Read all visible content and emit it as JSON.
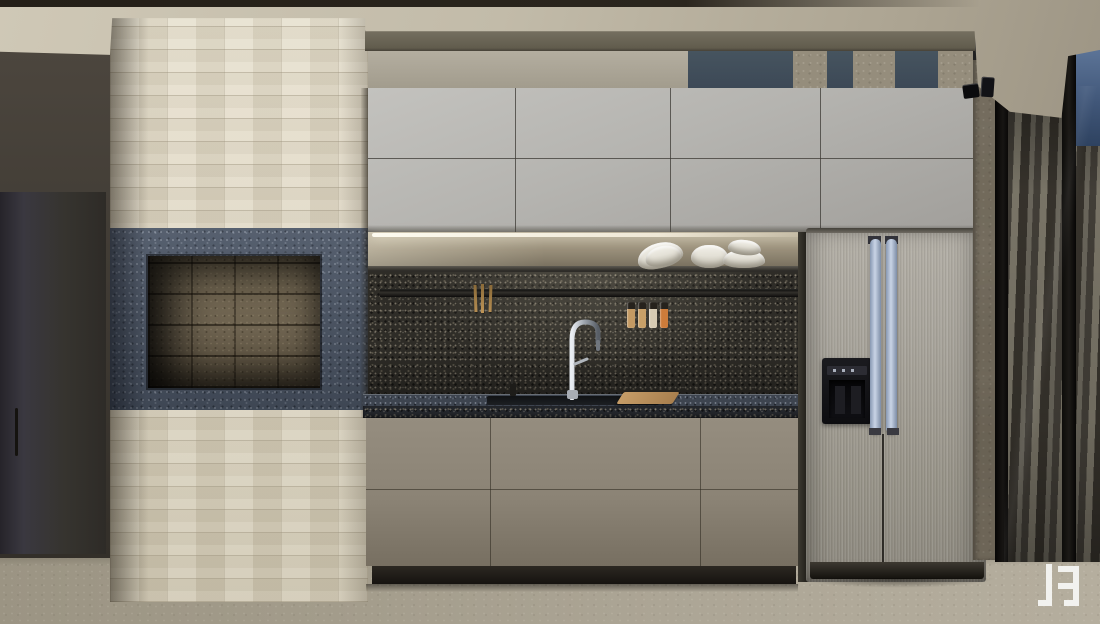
{
  "scene": {
    "description": "Photorealistic 3D architectural rendering of a modern kitchen elevation with stone fireplace column, gray cabinetry, dark granite backsplash, stainless refrigerator and curtained window wall",
    "room": "kitchen",
    "render_style": "interior visualization"
  },
  "regions": {
    "ceiling": {
      "material": "plaster",
      "color": "#c2bbaa"
    },
    "left_wall": {
      "material": "dark painted panel",
      "color": "#3e3933",
      "door": {
        "color": "#34313a",
        "handle_color": "#17150f"
      }
    },
    "stone_column": {
      "material": "cream stacked-stone brick",
      "color": "#ded7c3"
    },
    "fireplace": {
      "surround_material": "gray granite",
      "surround_color": "#4c5666",
      "niche_material": "firebrick",
      "niche_color": "#6f6450"
    },
    "soffit": {
      "band_color": "#6a6455",
      "panel_color": "#a9a396"
    },
    "exterior_glimpse": {
      "glass_color": "#414e5c",
      "pillar_color": "#8d887a"
    },
    "upper_cabinets": {
      "color": "#b3b2ae",
      "door_rows": 2,
      "door_columns": 4
    },
    "open_shelf": {
      "shelf_color": "#3a3833",
      "led_strip_color": "#f7f3e4",
      "items": [
        "tilted bowl stack",
        "single bowl",
        "stacked bowls"
      ]
    },
    "backsplash": {
      "material": "dark granite",
      "color": "#2e2c27",
      "rail_items": [
        "wooden utensils",
        "spice jars"
      ]
    },
    "spice_jars": {
      "count": 4,
      "colors": [
        "#c49a63",
        "#c8a068",
        "#d6cab2",
        "#cd7c3a"
      ]
    },
    "countertop": {
      "material": "dark granite",
      "surface_color": "#3d444f",
      "items": [
        "soap pump",
        "chrome gooseneck faucet",
        "undermount sink",
        "wooden cutting board"
      ]
    },
    "base_cabinets": {
      "color": "#8a8274",
      "drawer_columns": 3,
      "drawer_rows": 2,
      "toe_kick_color": "#25221d"
    },
    "refrigerator": {
      "type": "side-by-side",
      "finish": "brushed stainless steel",
      "body_color": "#a19d94",
      "handle_color": "#b7c4d8",
      "dispenser_color": "#101014",
      "plinth_color": "#241f19"
    },
    "right_wall": {
      "material": "concrete",
      "color": "#8c8373"
    },
    "ceiling_spotlights": {
      "count": 2,
      "color": "#0c0c0e"
    },
    "window_wall": {
      "curtain_color": "#6b665b",
      "frame_color": "#0b0a09",
      "sky_color": "#4a6188"
    },
    "floor": {
      "material": "concrete screed",
      "color": "#a8a190"
    },
    "watermark": {
      "glyph": "stylized monogram logo",
      "color": "#f5f5f3",
      "position": "bottom-right"
    }
  }
}
